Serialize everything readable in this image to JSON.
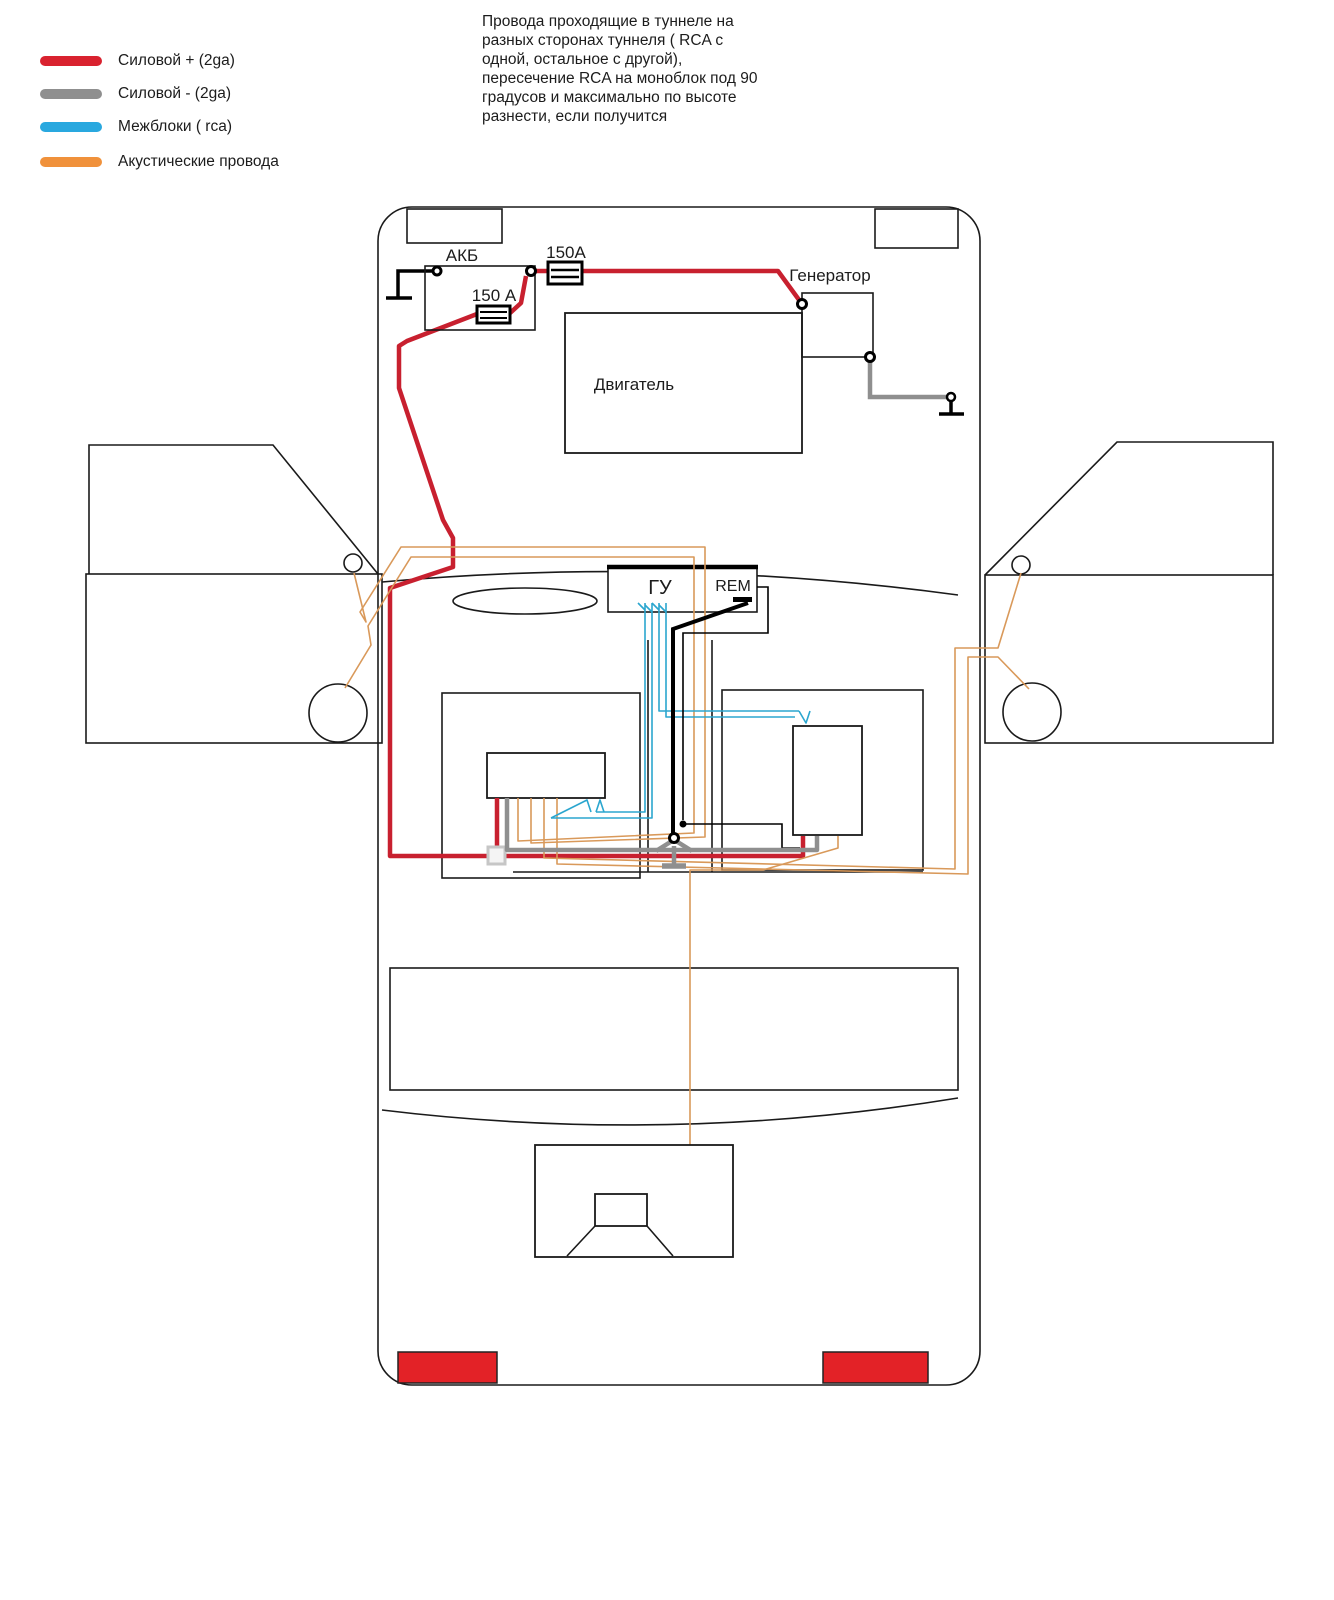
{
  "note": {
    "lines": [
      "Провода проходящие в туннеле на",
      "разных сторонах туннеля ( RCA с",
      "одной, остальное с другой),",
      "пересечение RCA на моноблок под 90",
      "градусов и максимально по высоте",
      "разнести, если получится"
    ]
  },
  "legend": {
    "items": [
      {
        "label": "Силовой + (2ga)",
        "color": "#d9222f"
      },
      {
        "label": "Силовой - (2ga)",
        "color": "#8f8f8f"
      },
      {
        "label": "Межблоки ( rca)",
        "color": "#29a8df"
      },
      {
        "label": "Акустические провода",
        "color": "#f0913b"
      }
    ]
  },
  "diagram": {
    "labels": {
      "battery": "АКБ",
      "fuse_main": "150А",
      "fuse_inner": "150 А",
      "generator": "Генератор",
      "engine": "Двигатель",
      "head_unit": "ГУ",
      "rem": "REM"
    },
    "wire_colors": {
      "power_positive": "#c8202f",
      "power_negative": "#8f8f8f",
      "interconnect_rca": "#2ba6cf",
      "acoustic": "#d9995a",
      "remote": "#000000"
    },
    "tail_light_color": "#e32227"
  }
}
